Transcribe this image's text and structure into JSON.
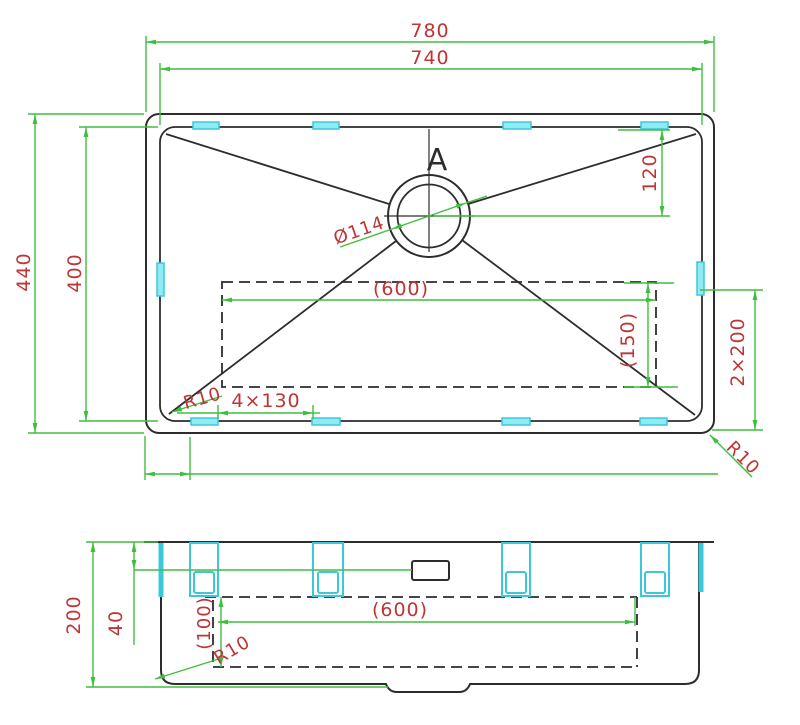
{
  "drawing": {
    "type": "cad-sink-technical-drawing",
    "colors": {
      "outline": "#2d2d2d",
      "dimension_line": "#3fbf3f",
      "dimension_text": "#bf3434",
      "clip": "#3cc8da",
      "background": "#ffffff"
    },
    "top_view": {
      "width_outer": "780",
      "width_inner": "740",
      "height_outer": "440",
      "height_inner": "400",
      "drain_offset_top": "120",
      "drain_diameter": "Ø114",
      "base_width": "(600)",
      "base_height": "(150)",
      "right_offset": "2×200",
      "clip_pitch": "4×130",
      "corner_radius_left": "R10",
      "corner_radius_right": "R10",
      "section_label": "A"
    },
    "side_view": {
      "total_height": "200",
      "rim_height": "40",
      "bowl_hidden_depth": "(100)",
      "bowl_width": "(600)",
      "bottom_radius": "R10"
    }
  }
}
